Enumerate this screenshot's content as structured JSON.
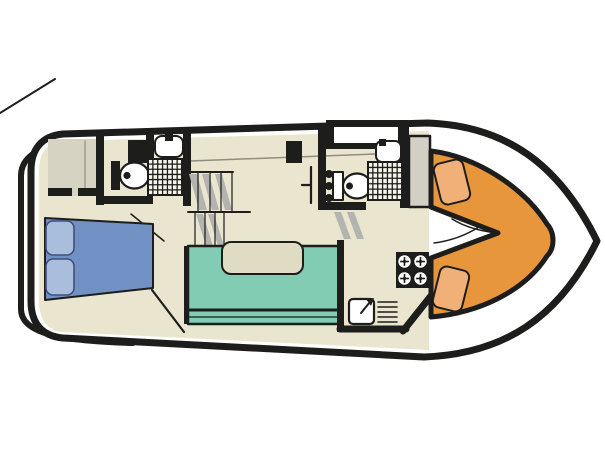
{
  "diagram": {
    "type": "boat-floorplan",
    "canvas": {
      "width": 605,
      "height": 454,
      "background": "#ffffff"
    },
    "colors": {
      "ink": "#1d1d1b",
      "white": "#ffffff",
      "floor": "#e9e5cf",
      "deck": "#d7d3c2",
      "cabinet": "#d2cfc4",
      "gray_line": "#8f8d80",
      "shadow": "#b5b3b0",
      "shower": "#f7f5ea",
      "bed": "#7191c4",
      "pillow": "#a9bedd",
      "pillow_line": "#41507a",
      "sofa": "#82ccb4",
      "table": "#e0dcc4",
      "orange": "#e8963c",
      "seat": "#f0b078"
    },
    "shapes": [
      {
        "name": "stern-line",
        "type": "line",
        "x1": 0,
        "y1": 113,
        "x2": 55,
        "y2": 79,
        "stroke": "@ink",
        "sw": 2
      },
      {
        "name": "stern-rail",
        "type": "path",
        "d": "M 133 136 C 58 138 21 148 21 176 L 21 309 C 21 333 58 341 133 343",
        "stroke": "@ink",
        "sw": 6
      },
      {
        "name": "hull",
        "type": "path",
        "d": "M 63 134 L 428 123 C 506 126 559 164 597 241 C 559 318 504 354 424 357 L 63 338 C 41 336 31 322 31 301 L 31 171 C 31 150 41 136 63 134 Z",
        "fill": "@white",
        "stroke": "@ink",
        "sw": 7
      },
      {
        "name": "cabin-floor",
        "type": "path",
        "d": "M 63 141 L 429 131 L 429 350 L 63 332 C 48 331 39 320 39 301 L 39 171 C 39 152 48 142 63 141 Z",
        "fill": "@floor"
      },
      {
        "name": "side-deck-line",
        "type": "line",
        "x1": 190,
        "y1": 161,
        "x2": 428,
        "y2": 152,
        "stroke": "@gray_line",
        "sw": 1.5
      },
      {
        "name": "wardrobe",
        "type": "rect",
        "x": 48,
        "y": 139,
        "w": 48,
        "h": 57,
        "fill": "@deck"
      },
      {
        "name": "wardrobe-divider",
        "type": "line",
        "x1": 85,
        "y1": 141,
        "x2": 85,
        "y2": 188,
        "stroke": "@gray_line",
        "sw": 1.2
      },
      {
        "name": "wardrobe-wall-a",
        "type": "rect",
        "x": 48,
        "y": 188,
        "w": 24,
        "h": 8,
        "fill": "@ink"
      },
      {
        "name": "wardrobe-wall-b",
        "type": "rect",
        "x": 78,
        "y": 188,
        "w": 18,
        "h": 8,
        "fill": "@ink"
      },
      {
        "name": "aft-bathroom-wall-left",
        "type": "rect",
        "x": 96,
        "y": 133,
        "w": 8,
        "h": 72,
        "fill": "@ink"
      },
      {
        "name": "aft-bathroom-wall-right",
        "type": "rect",
        "x": 183,
        "y": 132,
        "w": 8,
        "h": 74,
        "fill": "@ink"
      },
      {
        "name": "aft-bathroom-wall-bottom",
        "type": "rect",
        "x": 96,
        "y": 196,
        "w": 57,
        "h": 8,
        "fill": "@ink"
      },
      {
        "name": "aft-bathroom-bulkhead",
        "type": "rect",
        "x": 128,
        "y": 140,
        "w": 22,
        "h": 23,
        "fill": "@ink"
      },
      {
        "name": "aft-sink-stub",
        "type": "rect",
        "x": 146,
        "y": 132,
        "w": 8,
        "h": 27,
        "fill": "@ink"
      },
      {
        "name": "aft-sink",
        "type": "rect",
        "x": 155,
        "y": 136,
        "w": 28,
        "h": 21,
        "rx": 7,
        "fill": "@white",
        "stroke": "@ink",
        "sw": 2
      },
      {
        "name": "aft-sink-faucet",
        "type": "rect",
        "x": 165,
        "y": 134,
        "w": 8,
        "h": 7,
        "fill": "@ink"
      },
      {
        "name": "aft-toilet-cistern",
        "type": "rect",
        "x": 111,
        "y": 161,
        "w": 9,
        "h": 29,
        "fill": "@ink"
      },
      {
        "name": "aft-toilet-bowl",
        "type": "ellipse",
        "cx": 134.5,
        "cy": 175.5,
        "rx": 14.5,
        "ry": 13,
        "fill": "@white",
        "stroke": "@ink",
        "sw": 2.2
      },
      {
        "name": "aft-toilet-flush",
        "type": "circle",
        "cx": 127,
        "cy": 175.5,
        "r": 3.6,
        "fill": "@ink"
      },
      {
        "name": "aft-shower-tray",
        "type": "grid",
        "x": 148,
        "y": 159,
        "w": 34,
        "h": 36,
        "cols": 7,
        "rows": 7,
        "fill": "@shower",
        "stroke": "@ink",
        "sw": 1.3
      },
      {
        "name": "aft-door-swing",
        "type": "line",
        "x1": 131,
        "y1": 214,
        "x2": 164,
        "y2": 241,
        "stroke": "@ink",
        "sw": 1.5
      },
      {
        "name": "double-bed",
        "type": "polygon",
        "points": "45,218 153,224 153,288 45,300",
        "fill": "@bed",
        "stroke": "@ink",
        "sw": 2
      },
      {
        "name": "pillow-top",
        "type": "rect",
        "x": 46,
        "y": 221,
        "w": 28,
        "h": 34,
        "rx": 7,
        "fill": "@pillow",
        "stroke": "@pillow_line",
        "sw": 1.6
      },
      {
        "name": "pillow-bottom",
        "type": "rect",
        "x": 46,
        "y": 259,
        "w": 28,
        "h": 36,
        "rx": 7,
        "fill": "@pillow",
        "stroke": "@pillow_line",
        "sw": 1.6
      },
      {
        "name": "bed-step-edge",
        "type": "line",
        "x1": 152,
        "y1": 290,
        "x2": 184,
        "y2": 332,
        "stroke": "@ink",
        "sw": 2.2
      },
      {
        "name": "stairs-aft-top-edge",
        "type": "line",
        "x1": 188,
        "y1": 172,
        "x2": 233,
        "y2": 172,
        "stroke": "@ink",
        "sw": 2
      },
      {
        "name": "stairs-aft-mid-edge",
        "type": "line",
        "x1": 188,
        "y1": 212,
        "x2": 250,
        "y2": 212,
        "stroke": "@ink",
        "sw": 2
      },
      {
        "name": "stairs-aft-shadow-1",
        "type": "polygon",
        "points": "189,174 197,174 207,210 199,210",
        "fill": "@shadow"
      },
      {
        "name": "stairs-aft-shadow-2",
        "type": "polygon",
        "points": "202,174 209,174 219,210 212,210",
        "fill": "@shadow"
      },
      {
        "name": "stairs-aft-shadow-3",
        "type": "polygon",
        "points": "215,174 222,174 232,210 225,210",
        "fill": "@shadow"
      },
      {
        "name": "stairs-aft-tread-1",
        "type": "line",
        "x1": 198,
        "y1": 172,
        "x2": 198,
        "y2": 212,
        "stroke": "@ink",
        "sw": 1.2
      },
      {
        "name": "stairs-aft-tread-2",
        "type": "line",
        "x1": 210,
        "y1": 172,
        "x2": 210,
        "y2": 212,
        "stroke": "@ink",
        "sw": 1.2
      },
      {
        "name": "stairs-aft-tread-3",
        "type": "line",
        "x1": 221,
        "y1": 172,
        "x2": 221,
        "y2": 212,
        "stroke": "@ink",
        "sw": 1.2
      },
      {
        "name": "stairs-aft-tread-4",
        "type": "line",
        "x1": 232,
        "y1": 172,
        "x2": 232,
        "y2": 212,
        "stroke": "@ink",
        "sw": 1.2
      },
      {
        "name": "stairs-lower-shadow-1",
        "type": "polygon",
        "points": "196,214 203,214 213,246 206,246",
        "fill": "@shadow"
      },
      {
        "name": "stairs-lower-shadow-2",
        "type": "polygon",
        "points": "208,214 214,214 224,246 218,246",
        "fill": "@shadow"
      },
      {
        "name": "stairs-lower-tread-1",
        "type": "line",
        "x1": 195,
        "y1": 212,
        "x2": 195,
        "y2": 247,
        "stroke": "@ink",
        "sw": 1.2
      },
      {
        "name": "stairs-lower-tread-2",
        "type": "line",
        "x1": 205,
        "y1": 212,
        "x2": 205,
        "y2": 247,
        "stroke": "@ink",
        "sw": 1.2
      },
      {
        "name": "stairs-lower-tread-3",
        "type": "line",
        "x1": 215,
        "y1": 212,
        "x2": 215,
        "y2": 247,
        "stroke": "@ink",
        "sw": 1.2
      },
      {
        "name": "stairs-lower-tread-4",
        "type": "line",
        "x1": 224,
        "y1": 212,
        "x2": 224,
        "y2": 247,
        "stroke": "@ink",
        "sw": 1.2
      },
      {
        "name": "saloon-wall-left",
        "type": "rect",
        "x": 184,
        "y": 246,
        "w": 5,
        "h": 78,
        "fill": "@ink"
      },
      {
        "name": "dinette-sofa",
        "type": "rect",
        "x": 188,
        "y": 246,
        "w": 152,
        "h": 78,
        "fill": "@sofa",
        "stroke": "@ink",
        "sw": 2.5
      },
      {
        "name": "sofa-back-edge",
        "type": "line",
        "x1": 189,
        "y1": 310,
        "x2": 339,
        "y2": 310,
        "stroke": "@ink",
        "sw": 3
      },
      {
        "name": "sofa-back-edge-2",
        "type": "line",
        "x1": 189,
        "y1": 317,
        "x2": 339,
        "y2": 317,
        "stroke": "@ink",
        "sw": 1.2
      },
      {
        "name": "dinette-table",
        "type": "rect",
        "x": 222,
        "y": 242,
        "w": 81,
        "h": 32,
        "rx": 9,
        "fill": "@table",
        "stroke": "@ink",
        "sw": 2
      },
      {
        "name": "corridor-bulkhead",
        "type": "rect",
        "x": 286,
        "y": 141,
        "w": 16,
        "h": 22,
        "fill": "@ink"
      },
      {
        "name": "corridor-door",
        "type": "line",
        "x1": 311,
        "y1": 167,
        "x2": 311,
        "y2": 203,
        "stroke": "@ink",
        "sw": 2.2
      },
      {
        "name": "corridor-door-handle",
        "type": "line",
        "x1": 302,
        "y1": 185,
        "x2": 311,
        "y2": 185,
        "stroke": "@ink",
        "sw": 2.2
      },
      {
        "name": "fore-hatch-frame",
        "type": "rect",
        "x": 326,
        "y": 120,
        "w": 82,
        "h": 29,
        "fill": "@ink"
      },
      {
        "name": "fore-hatch-window",
        "type": "rect",
        "x": 334,
        "y": 127,
        "w": 64,
        "h": 16,
        "fill": "@white"
      },
      {
        "name": "fore-bathroom-wall-left",
        "type": "rect",
        "x": 318,
        "y": 126,
        "w": 8,
        "h": 84,
        "fill": "@ink"
      },
      {
        "name": "fore-bathroom-wall-bottom",
        "type": "rect",
        "x": 318,
        "y": 202,
        "w": 48,
        "h": 8,
        "fill": "@ink"
      },
      {
        "name": "fore-bathroom-wall-right",
        "type": "rect",
        "x": 400,
        "y": 126,
        "w": 9,
        "h": 82,
        "fill": "@ink"
      },
      {
        "name": "fore-sink",
        "type": "rect",
        "x": 376,
        "y": 141,
        "w": 25,
        "h": 21,
        "rx": 6,
        "fill": "@white",
        "stroke": "@ink",
        "sw": 2
      },
      {
        "name": "fore-sink-faucet",
        "type": "rect",
        "x": 379,
        "y": 139,
        "w": 7,
        "h": 7,
        "fill": "@ink"
      },
      {
        "name": "fore-toilet-tank",
        "type": "rect",
        "x": 333,
        "y": 172,
        "w": 10,
        "h": 28,
        "fill": "@white",
        "stroke": "@ink",
        "sw": 2
      },
      {
        "name": "fore-toilet-bowl",
        "type": "ellipse",
        "cx": 357,
        "cy": 186,
        "rx": 14,
        "ry": 12.5,
        "fill": "@white",
        "stroke": "@ink",
        "sw": 2.2
      },
      {
        "name": "fore-toilet-flush",
        "type": "circle",
        "cx": 349.5,
        "cy": 186,
        "r": 3.5,
        "fill": "@ink"
      },
      {
        "name": "hinge-dot-1",
        "type": "circle",
        "cx": 329,
        "cy": 174,
        "r": 4,
        "fill": "@ink"
      },
      {
        "name": "hinge-dot-2",
        "type": "circle",
        "cx": 329,
        "cy": 186,
        "r": 4,
        "fill": "@ink"
      },
      {
        "name": "hinge-dot-3",
        "type": "circle",
        "cx": 329,
        "cy": 198,
        "r": 4,
        "fill": "@ink"
      },
      {
        "name": "fore-shower-tray",
        "type": "grid",
        "x": 368,
        "y": 162,
        "w": 34,
        "h": 38,
        "cols": 7,
        "rows": 7,
        "fill": "@shower",
        "stroke": "@ink",
        "sw": 1.3
      },
      {
        "name": "fore-steps-shadow-1",
        "type": "polygon",
        "points": "334,212 341,212 351,239 344,239",
        "fill": "@shadow"
      },
      {
        "name": "fore-steps-shadow-2",
        "type": "polygon",
        "points": "347,212 354,212 364,239 357,239",
        "fill": "@shadow"
      },
      {
        "name": "galley-partition",
        "type": "rect",
        "x": 337,
        "y": 240,
        "w": 7,
        "h": 92,
        "fill": "@ink"
      },
      {
        "name": "galley-wall-bottom",
        "type": "line",
        "x1": 340,
        "y1": 329,
        "x2": 406,
        "y2": 329,
        "stroke": "@ink",
        "sw": 7
      },
      {
        "name": "galley-wall-diagonal",
        "type": "line",
        "x1": 403,
        "y1": 331,
        "x2": 434,
        "y2": 292,
        "stroke": "@ink",
        "sw": 7
      },
      {
        "name": "stove",
        "type": "rect",
        "x": 396,
        "y": 252,
        "w": 33,
        "h": 36,
        "fill": "@ink"
      },
      {
        "name": "stove-burner-1",
        "type": "burner",
        "cx": 404.5,
        "cy": 261.5,
        "r": 6.2
      },
      {
        "name": "stove-burner-2",
        "type": "burner",
        "cx": 420.5,
        "cy": 261.5,
        "r": 6.2
      },
      {
        "name": "stove-burner-3",
        "type": "burner",
        "cx": 404.5,
        "cy": 278.5,
        "r": 6.2
      },
      {
        "name": "stove-burner-4",
        "type": "burner",
        "cx": 420.5,
        "cy": 278.5,
        "r": 6.2
      },
      {
        "name": "galley-sink",
        "type": "rect",
        "x": 349,
        "y": 299,
        "w": 25,
        "h": 25,
        "rx": 4,
        "fill": "@white",
        "stroke": "@ink",
        "sw": 2.2
      },
      {
        "name": "galley-faucet",
        "type": "line",
        "x1": 361,
        "y1": 313,
        "x2": 370,
        "y2": 302,
        "stroke": "@ink",
        "sw": 2
      },
      {
        "name": "galley-faucet-head",
        "type": "polygon",
        "points": "366,299 374,298 371,306",
        "fill": "@ink"
      },
      {
        "name": "drainer-line-1",
        "type": "line",
        "x1": 378,
        "y1": 302,
        "x2": 397,
        "y2": 302,
        "stroke": "@ink",
        "sw": 1.5
      },
      {
        "name": "drainer-line-2",
        "type": "line",
        "x1": 378,
        "y1": 307,
        "x2": 397,
        "y2": 307,
        "stroke": "@ink",
        "sw": 1.5
      },
      {
        "name": "drainer-line-3",
        "type": "line",
        "x1": 378,
        "y1": 312,
        "x2": 397,
        "y2": 312,
        "stroke": "@ink",
        "sw": 1.5
      },
      {
        "name": "drainer-line-4",
        "type": "line",
        "x1": 378,
        "y1": 317,
        "x2": 397,
        "y2": 317,
        "stroke": "@ink",
        "sw": 1.5
      },
      {
        "name": "drainer-line-5",
        "type": "line",
        "x1": 378,
        "y1": 322,
        "x2": 397,
        "y2": 322,
        "stroke": "@ink",
        "sw": 1.5
      },
      {
        "name": "helm-cabinet",
        "type": "rect",
        "x": 409,
        "y": 136,
        "w": 21,
        "h": 71,
        "fill": "@cabinet",
        "stroke": "@ink",
        "sw": 2.5
      },
      {
        "name": "bow-cockpit",
        "type": "path",
        "d": "M 431 151 C 478 157 524 188 547 224 C 555 233 555 248 547 256 C 524 292 478 313 431 317 L 431 258 L 498 233 L 431 207 Z",
        "fill": "@orange",
        "stroke": "@ink",
        "sw": 5
      },
      {
        "name": "bow-seat-top",
        "type": "rect",
        "x": 437,
        "y": 161,
        "w": 30,
        "h": 42,
        "rx": 7,
        "fill": "@seat",
        "stroke": "@ink",
        "sw": 2,
        "transform": "rotate(-14 452 182)"
      },
      {
        "name": "bow-seat-bottom",
        "type": "rect",
        "x": 436,
        "y": 268,
        "w": 30,
        "h": 42,
        "rx": 7,
        "fill": "@seat",
        "stroke": "@ink",
        "sw": 2,
        "transform": "rotate(14 451 289)"
      },
      {
        "name": "bow-door-swing",
        "type": "path",
        "d": "M 434 243 Q 458 240 479 227",
        "stroke": "@ink",
        "sw": 1.5
      },
      {
        "name": "bow-wedge-line",
        "type": "path",
        "d": "M 497 233 Q 470 230 452 219",
        "stroke": "@ink",
        "sw": 1.5
      }
    ]
  }
}
